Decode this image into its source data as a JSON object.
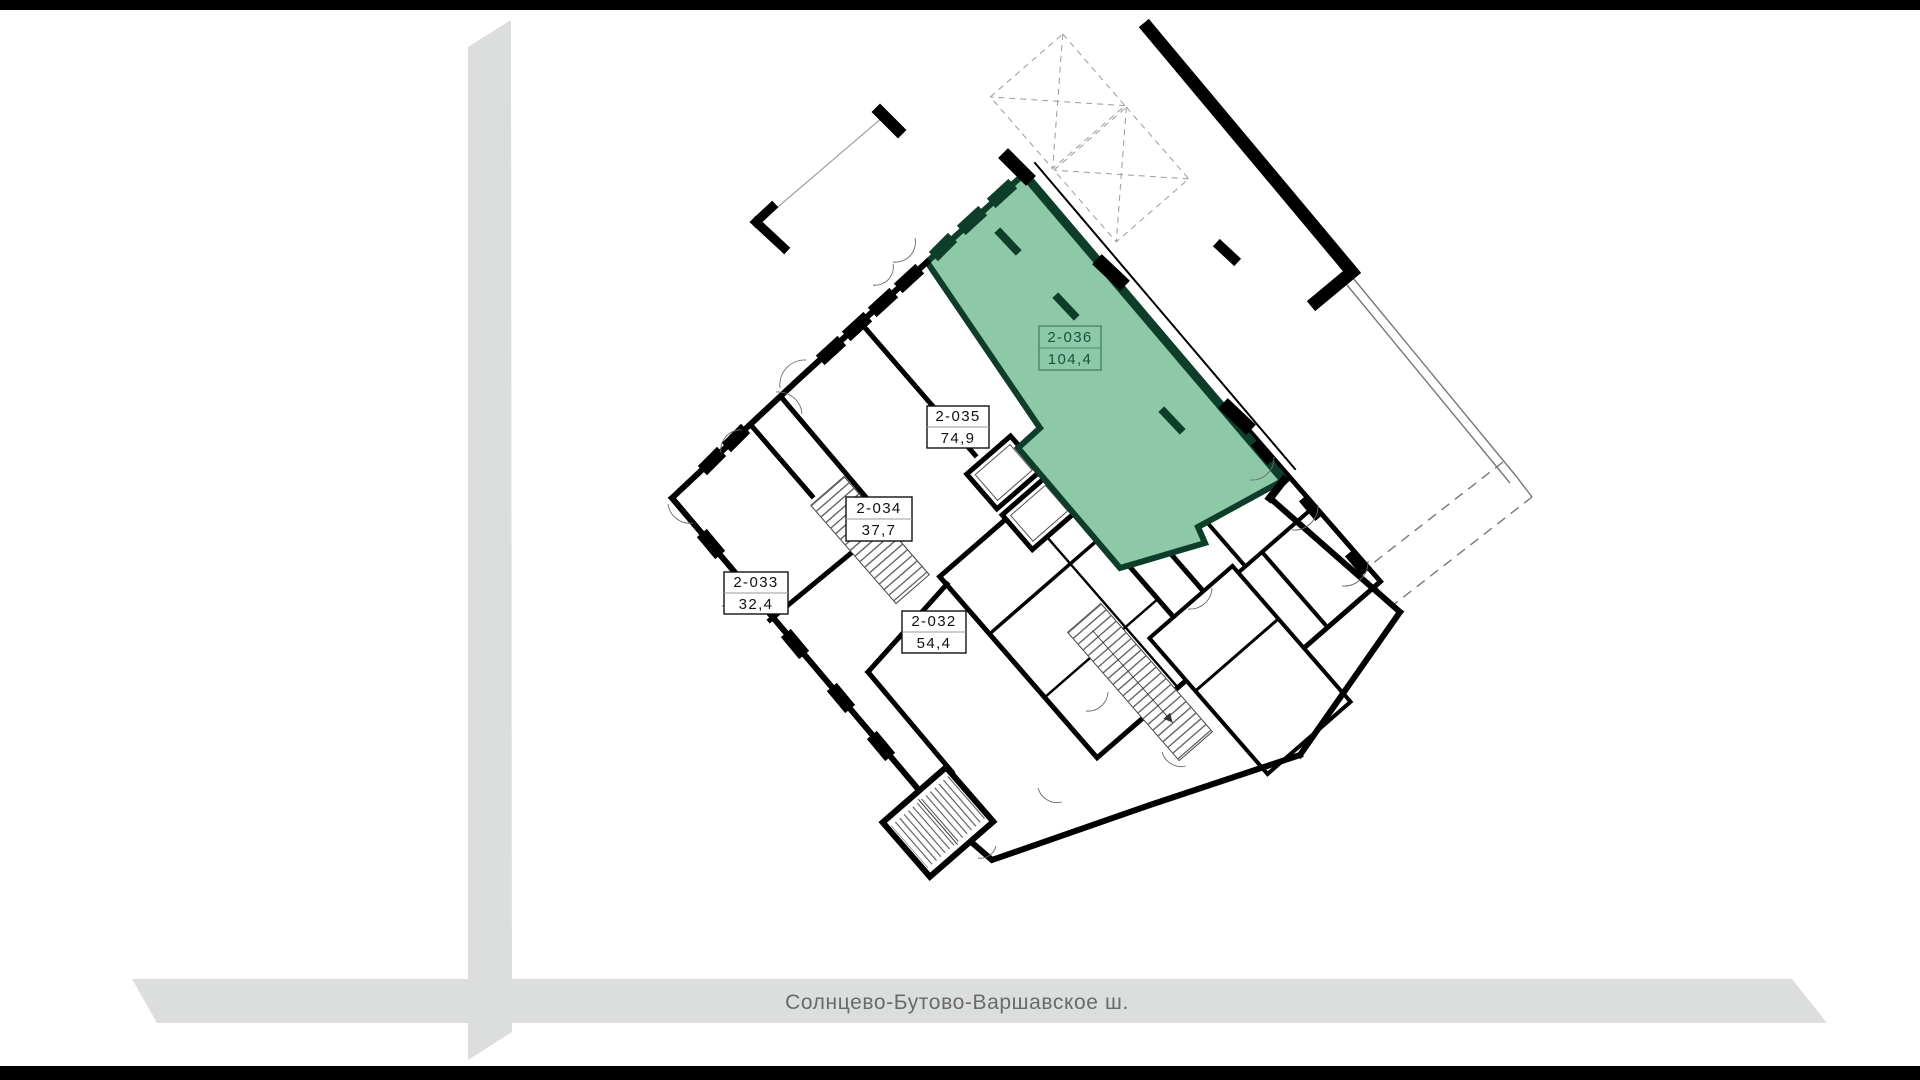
{
  "plan": {
    "units": [
      {
        "id": "2-036",
        "area": "104,4",
        "highlighted": true
      },
      {
        "id": "2-035",
        "area": "74,9",
        "highlighted": false
      },
      {
        "id": "2-034",
        "area": "37,7",
        "highlighted": false
      },
      {
        "id": "2-033",
        "area": "32,4",
        "highlighted": false
      },
      {
        "id": "2-032",
        "area": "54,4",
        "highlighted": false
      }
    ]
  },
  "street": {
    "name": "Солнцево-Бутово-Варшавское ш."
  },
  "colors": {
    "highlight_fill": "#8dc9a8",
    "highlight_wall": "#0e3d2a",
    "highlight_text": "#155441",
    "wall": "#000000",
    "road": "#dcdddd",
    "road_text": "#696a6a",
    "frame_bar": "#000000",
    "background": "#ffffff"
  }
}
